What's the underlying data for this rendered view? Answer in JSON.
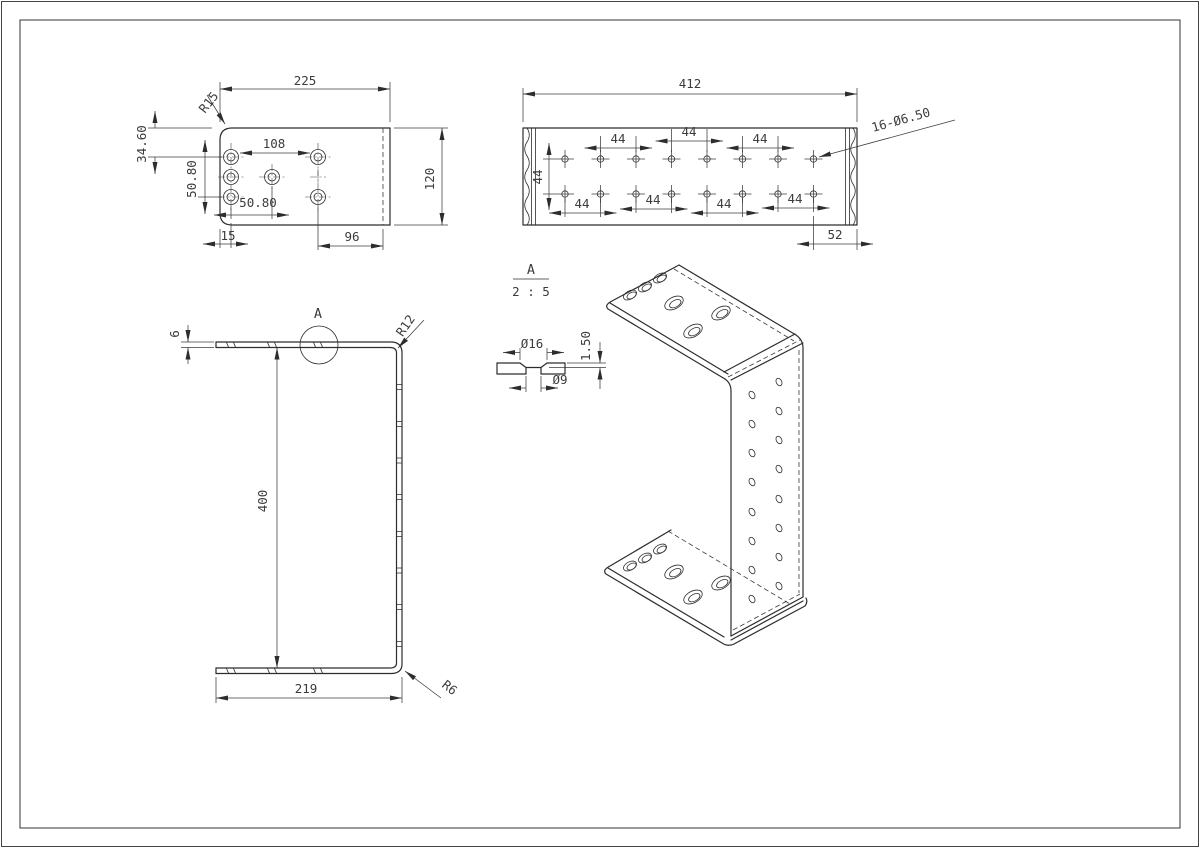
{
  "style": {
    "background": "#ffffff",
    "line_color": "#2d2d2d",
    "dimension_color": "#3c3c3c"
  },
  "flange_view": {
    "width": "225",
    "edge_to_first_hole": "34.60",
    "vertical_pitch": "50.80",
    "horizontal_pitch": "108",
    "second_horizontal_pitch": "50.80",
    "edge_margin": "15",
    "hole_to_bend": "96",
    "depth": "120",
    "corner_radius": "R15"
  },
  "web_view": {
    "length": "412",
    "top_pitches": [
      "44",
      "44",
      "44"
    ],
    "row_pitch": "44",
    "bottom_pitches": [
      "44",
      "44",
      "44",
      "44"
    ],
    "end_margin": "52",
    "hole_callout": "16-Ø6.50"
  },
  "profile_view": {
    "thickness": "6",
    "detail_marker": "A",
    "top_bend_radius": "R12",
    "height": "400",
    "flange_length": "219",
    "bottom_bend_radius": "R6"
  },
  "detail_view": {
    "label": "A",
    "scale": "2 : 5",
    "countersink_diameter": "Ø16",
    "hole_diameter": "Ø9",
    "countersink_depth": "1.50"
  }
}
